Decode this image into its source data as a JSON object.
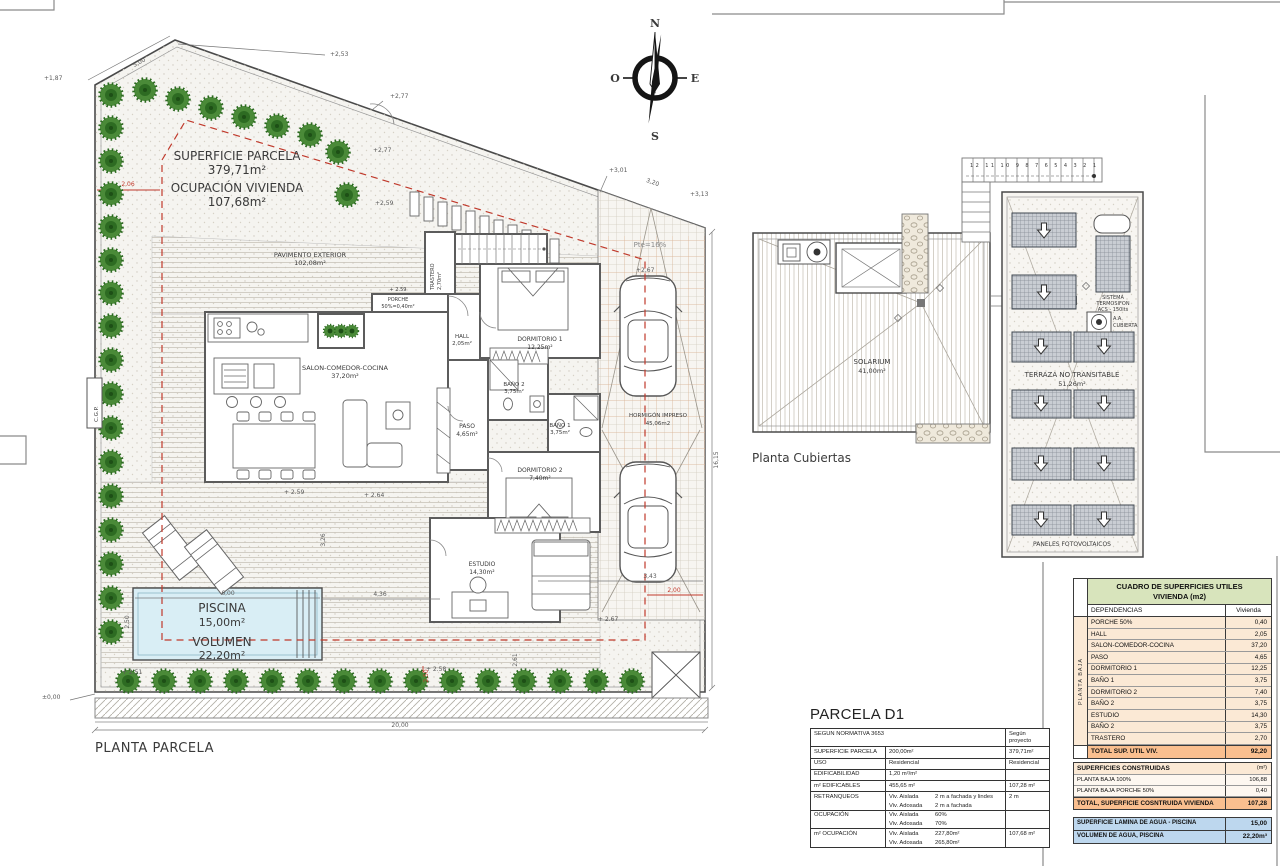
{
  "colors": {
    "line": "#4a4a4a",
    "red_dashed": "#c0392b",
    "tree_green": "#2d6b22",
    "pool_blue": "#d9eef5",
    "table_title_green": "#d8e4bc",
    "table_row_peach": "#fbe9d5",
    "table_total_orange": "#fabf8f",
    "table_water_blue": "#bdd7ee"
  },
  "drawing": {
    "site_plan_title": "PLANTA PARCELA",
    "roof_plan_title": "Planta Cubiertas",
    "compass": {
      "n": "N",
      "s": "S",
      "e": "E",
      "o": "O"
    },
    "parcel": {
      "superficie_label": "SUPERFICIE PARCELA",
      "superficie_value": "379,71m²",
      "ocupacion_label": "OCUPACIÓN VIVIENDA",
      "ocupacion_value": "107,68m²",
      "pavimento_label": "PAVIMENTO EXTERIOR",
      "pavimento_value": "102,08m²",
      "cgp": "C.G.P."
    },
    "rooms": {
      "porche_level": "+ 2.59",
      "porche": "PORCHE",
      "porche_value": "50%=0,40m²",
      "trastero": "TRASTERO",
      "trastero_value": "2,70m²",
      "hall": "HALL",
      "hall_value": "2,05m²",
      "salon": "SALON-COMEDOR-COCINA",
      "salon_value": "37,20m²",
      "dormitorio1": "DORMITORIO 1",
      "dormitorio1_value": "12,25m²",
      "bano2": "BAÑO 2",
      "bano2_value": "3,75m²",
      "bano1": "BAÑO 1",
      "bano1_value": "3,75m²",
      "paso": "PASO",
      "paso_value": "4,65m²",
      "dormitorio2": "DORMITORIO 2",
      "dormitorio2_value": "7,40m²",
      "estudio": "ESTUDIO",
      "estudio_value": "14,30m²",
      "hormigon": "HORMIGÓN IMPRESO",
      "hormigon_value": "45,06m2",
      "piscina": "PISCINA",
      "piscina_value": "15,00m²",
      "volumen": "VOLUMEN",
      "volumen_value": "22,20m²",
      "pendiente": "Pte=16%"
    },
    "roof": {
      "solarium": "SOLARIUM",
      "solarium_value": "41,00m²",
      "terraza": "TERRAZA NO TRANSITABLE",
      "terraza_value": "51,26m²",
      "termosifon_1": "SISTEMA",
      "termosifon_2": "TERMOSIFON",
      "termosifon_3": "ACS - 150lts",
      "aa_1": "A.A.",
      "aa_2": "CUBIERTA",
      "paneles": "PANELES FOTOVOLTAICOS",
      "stair_numbers": "12 11 10 9 8 7 6 5 4 3 2 1"
    },
    "dims": {
      "c253": "+2,53",
      "l500": "5,00",
      "c187": "+1,87",
      "r206": "2,06",
      "c277a": "+2,77",
      "c277b": "+2,77",
      "c259a": "+2,59",
      "c301": "+3,01",
      "l320": "3,20",
      "c313": "+3,13",
      "v1615": "16,15",
      "c267a": "+2,67",
      "c259b": "+ 2.59",
      "c264": "+ 2.64",
      "p600": "6,00",
      "p250": "2,50",
      "v326": "3,26",
      "p436": "4,36",
      "g343": "3,43",
      "r200": "2,00",
      "v261": "2,61",
      "c267b": "+ 2.67",
      "c251": "+ 2.51",
      "c258": "+ 2.58",
      "zero": "±0,00",
      "b2000": "20,00",
      "r250": "2,50"
    }
  },
  "parcela_table": {
    "title": "PARCELA D1",
    "header_left": "SEGUN NORMATIVA 3653",
    "header_right": "Según proyecto",
    "rows": [
      {
        "label": "SUPERFICIE PARCELA",
        "norm": "200,00m²",
        "proj": "379,71m²"
      },
      {
        "label": "USO",
        "norm": "Residencial",
        "proj": "Residencial"
      },
      {
        "label": "EDIFICABILIDAD",
        "norm": "1,20 m²/m²",
        "proj": ""
      },
      {
        "label": "m² EDIFICABLES",
        "norm": "455,65 m²",
        "proj": "107,28 m²"
      },
      {
        "label": "RETRANQUEOS",
        "norm_a": "Viv. Aislada",
        "norm_a2": "2 m a fachada y lindes",
        "norm_b": "Viv. Adosada",
        "norm_b2": "2 m a fachada",
        "proj": "2 m"
      },
      {
        "label": "OCUPACIÓN",
        "norm_a": "Viv. Aislada",
        "norm_a2": "60%",
        "norm_b": "Viv. Adosada",
        "norm_b2": "70%",
        "proj": ""
      },
      {
        "label": "m² OCUPACIÓN",
        "norm_a": "Viv. Aislada",
        "norm_a2": "227,80m²",
        "norm_b": "Viv. Adosada",
        "norm_b2": "265,80m²",
        "proj": "107,68 m²"
      }
    ]
  },
  "cuadro_table": {
    "title_1": "CUADRO DE SUPERFICIES UTILES",
    "title_2": "VIVIENDA (m2)",
    "col_dependencias": "DEPENDENCIAS",
    "col_vivienda": "Vivienda",
    "side_label": "PLANTA BAJA",
    "rows": [
      {
        "name": "PORCHE 50%",
        "value": "0,40"
      },
      {
        "name": "HALL",
        "value": "2,05"
      },
      {
        "name": "SALON-COMEDOR-COCINA",
        "value": "37,20"
      },
      {
        "name": "PASO",
        "value": "4,65"
      },
      {
        "name": "DORMITORIO 1",
        "value": "12,25"
      },
      {
        "name": "BAÑO 1",
        "value": "3,75"
      },
      {
        "name": "DORMITORIO 2",
        "value": "7,40"
      },
      {
        "name": "BAÑO 2",
        "value": "3,75"
      },
      {
        "name": "ESTUDIO",
        "value": "14,30"
      },
      {
        "name": "BAÑO 2",
        "value": "3,75"
      },
      {
        "name": "TRASTERO",
        "value": "2,70"
      }
    ],
    "total_label": "TOTAL SUP. UTIL VIV.",
    "total_value": "92,20",
    "constructed_header": "SUPERFICIES CONSTRUIDAS",
    "constructed_unit": "(m²)",
    "constructed_rows": [
      {
        "name": "PLANTA BAJA 100%",
        "value": "106,88"
      },
      {
        "name": "PLANTA BAJA PORCHE 50%",
        "value": "0,40"
      }
    ],
    "constructed_total_label": "TOTAL, SUPERFICIE COSNTRUIDA VIVIENDA",
    "constructed_total_value": "107,28",
    "water_rows": [
      {
        "name": "SUPERFICIE LAMINA DE AGUA - PISCINA",
        "value": "15,00"
      },
      {
        "name": "VOLUMEN DE AGUA, PISCINA",
        "value": "22,20m³"
      }
    ]
  }
}
